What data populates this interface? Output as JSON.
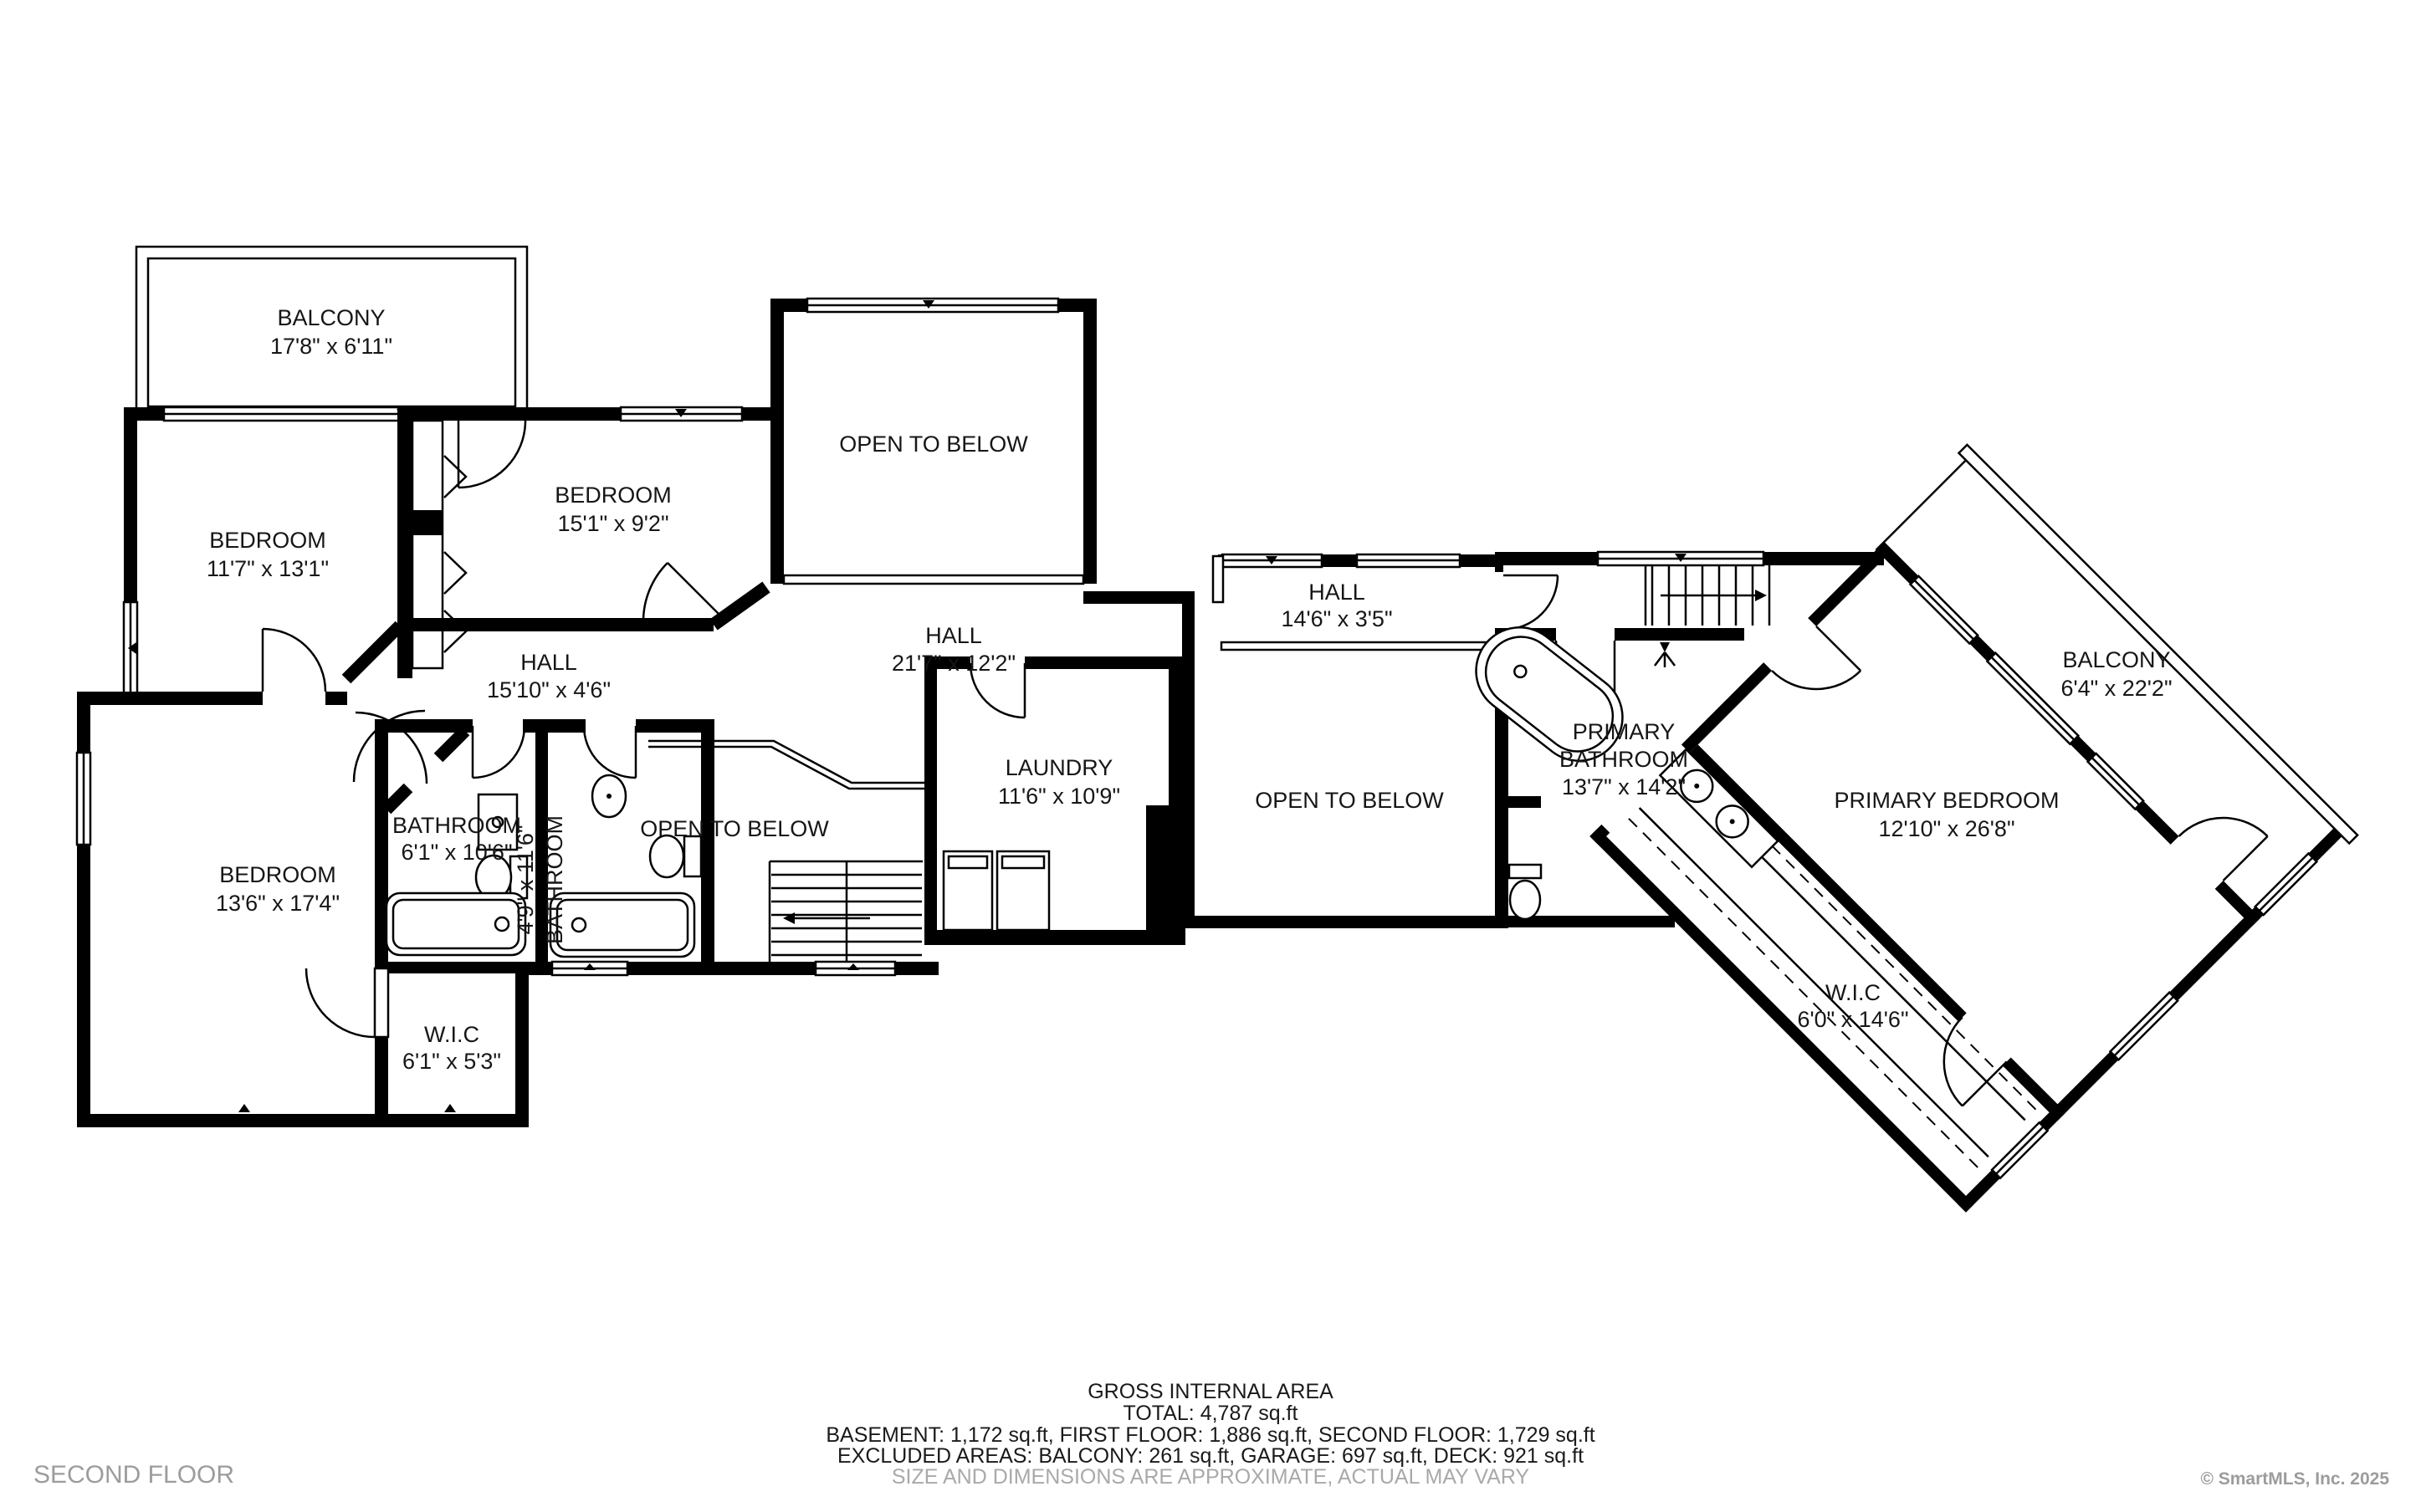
{
  "rooms": {
    "balcony_left": {
      "label": "BALCONY",
      "dims": "17'8\" x 6'11\""
    },
    "bedroom_left": {
      "label": "BEDROOM",
      "dims": "11'7\" x 13'1\""
    },
    "bedroom_top": {
      "label": "BEDROOM",
      "dims": "15'1\" x 9'2\""
    },
    "bedroom_lower": {
      "label": "BEDROOM",
      "dims": "13'6\" x 17'4\""
    },
    "open_below_top": {
      "label": "OPEN TO BELOW"
    },
    "open_below_left": {
      "label": "OPEN TO BELOW"
    },
    "open_below_middle": {
      "label": "OPEN TO BELOW"
    },
    "hall_main": {
      "label": "HALL",
      "dims": "21'7\" x 12'2\""
    },
    "hall_upper": {
      "label": "HALL",
      "dims": "14'6\" x 3'5\""
    },
    "hall_left": {
      "label": "HALL",
      "dims": "15'10\" x 4'6\""
    },
    "bathroom_hall": {
      "label": "BATHROOM",
      "dims": "6'1\" x 10'6\""
    },
    "bathroom_inner": {
      "label": "BATHROOM",
      "dims": "4'9\" x 11'6\""
    },
    "laundry": {
      "label": "LAUNDRY",
      "dims": "11'6\" x 10'9\""
    },
    "primary_bathroom": {
      "label_lines": [
        "PRIMARY",
        "BATHROOM"
      ],
      "dims": "13'7\" x 14'2\""
    },
    "primary_bedroom": {
      "label": "PRIMARY BEDROOM",
      "dims": "12'10\" x 26'8\""
    },
    "balcony_primary": {
      "label": "BALCONY",
      "dims": "6'4\" x 22'2\""
    },
    "wic_hall": {
      "label": "W.I.C",
      "dims": "6'1\" x 5'3\""
    },
    "wic_primary": {
      "label": "W.I.C",
      "dims": "6'0\" x 14'6\""
    }
  },
  "footer": {
    "title": "GROSS INTERNAL AREA",
    "total": "TOTAL: 4,787 sq.ft",
    "areas": "BASEMENT: 1,172 sq.ft, FIRST FLOOR: 1,886 sq.ft, SECOND FLOOR: 1,729 sq.ft",
    "excluded": "EXCLUDED AREAS: BALCONY: 261 sq.ft, GARAGE: 697 sq.ft, DECK: 921 sq.ft",
    "disclaimer": "SIZE AND DIMENSIONS ARE APPROXIMATE, ACTUAL MAY VARY"
  },
  "branding": {
    "floor_label": "SECOND FLOOR",
    "copyright": "© SmartMLS, Inc.  2025"
  },
  "colors": {
    "wall": "#000000",
    "label_text": "#161616",
    "muted_text": "#a9a9a9",
    "background": "#ffffff"
  }
}
